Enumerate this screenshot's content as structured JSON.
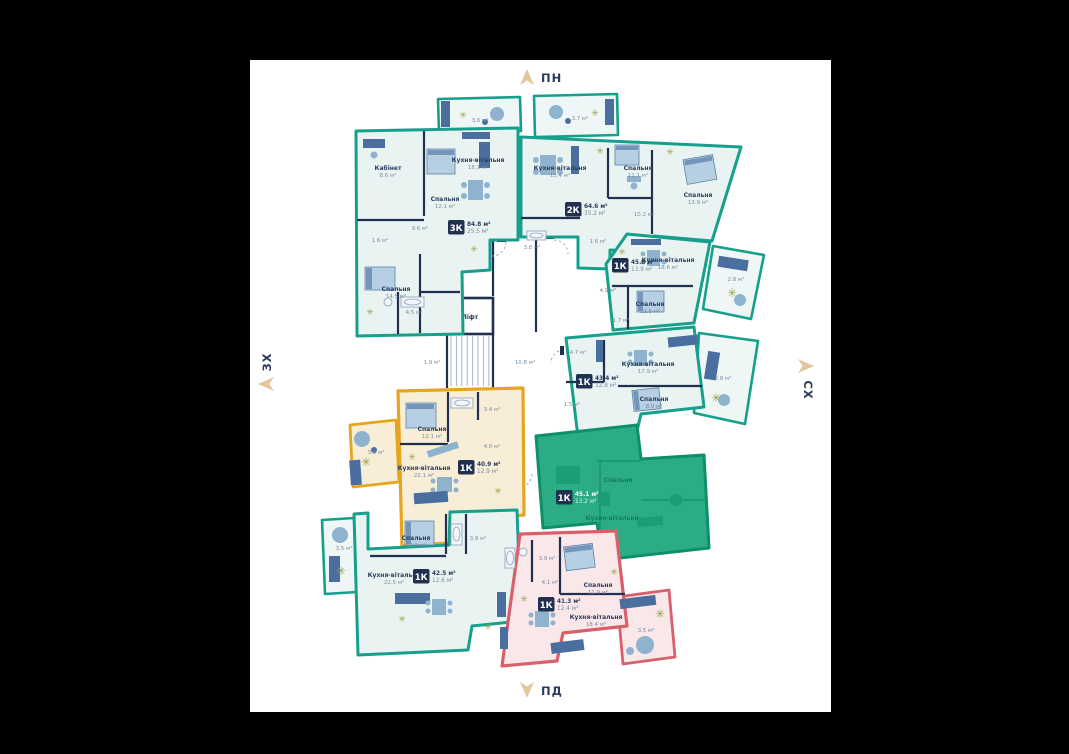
{
  "palette": {
    "available_teal": "#16a08c",
    "reserved_yellow": "#e6a41f",
    "unavailable_pink": "#d9606b",
    "sold_green": "#2bac85",
    "wall_navy": "#22304f",
    "compass_gold": "#e2c79e",
    "paper": "#ffffff",
    "background": "#000000"
  },
  "compass": {
    "north": "ПН",
    "south": "ПД",
    "west": "ЗХ",
    "east": "СХ"
  },
  "core": {
    "lift": "Ліфт",
    "hall_small_area": "1.9 м²",
    "hall_area": "10.8 м²"
  },
  "balconies": {
    "top_left": "3.6 м²",
    "top_right": "3.7 м²",
    "right_upper": "2.8 м²",
    "right_middle": "2.8 м²",
    "yellow": "3.5 м²",
    "bottom_left": "3.5 м²",
    "pink": "3.5 м²"
  },
  "apartments": {
    "a3k": {
      "type": "3К",
      "area_total": "84.8 м²",
      "area_living": "25.5 м²",
      "rooms": {
        "cabinet": {
          "name": "Кабінет",
          "area": "8.6 м²"
        },
        "bedroom1": {
          "name": "Спальня",
          "area": "12.1 м²"
        },
        "kitchen_living": {
          "name": "Кухня-вітальня",
          "area": "18.1 м²"
        },
        "bedroom2": {
          "name": "Спальня",
          "area": "14.5 м²"
        },
        "bath_area": "4.5 м²",
        "hall_area": "9.6 м²",
        "wc_area": "1.6 м²"
      }
    },
    "a2k": {
      "type": "2К",
      "area_total": "64.6 м²",
      "area_living": "35.2 м²",
      "rooms": {
        "kitchen_living": {
          "name": "Кухня-вітальня",
          "area": "15.4 м²"
        },
        "bedroom1": {
          "name": "Спальня",
          "area": "11.1 м²"
        },
        "bedroom2": {
          "name": "Спальня",
          "area": "13.9 м²"
        },
        "hall_area": "10.2 м²",
        "bath_area": "3.8 м²",
        "wc_area": "1.6 м²"
      }
    },
    "a1k_right": {
      "type": "1К",
      "area_total": "45.8 м²",
      "area_living": "13.9 м²",
      "rooms": {
        "kitchen_living": {
          "name": "Кухня-вітальня",
          "area": "18.6 м²"
        },
        "bedroom": {
          "name": "Спальня",
          "area": "12.5 м²"
        },
        "hall_area": "4.9 м²",
        "wc_area": "1.7 м²"
      }
    },
    "a1k_mid": {
      "type": "1К",
      "area_total": "43.4 м²",
      "area_living": "12.8 м²",
      "rooms": {
        "kitchen_living": {
          "name": "Кухня-вітальня",
          "area": "17.9 м²"
        },
        "bedroom": {
          "name": "Спальня",
          "area": "8.9 м²"
        },
        "hall_area": "4.7 м²",
        "wc_area": "1.5 м²"
      }
    },
    "a1k_yellow": {
      "type": "1К",
      "area_total": "40.9 м²",
      "area_living": "12.9 м²",
      "rooms": {
        "bedroom": {
          "name": "Спальня",
          "area": "12.1 м²"
        },
        "kitchen_living": {
          "name": "Кухня-вітальня",
          "area": "22.1 м²"
        },
        "bath_area": "3.4 м²",
        "hall_area": "4.0 м²"
      }
    },
    "a1k_sold": {
      "type": "1К",
      "area_total": "45.1 м²",
      "area_living": "13.2 м²",
      "rooms": {
        "bedroom": {
          "name": "Спальня"
        },
        "kitchen_living": {
          "name": "Кухня-вітальня"
        }
      }
    },
    "a1k_bottom": {
      "type": "1К",
      "area_total": "42.5 м²",
      "area_living": "12.6 м²",
      "rooms": {
        "bedroom": {
          "name": "Спальня",
          "area": "12.1 м²"
        },
        "kitchen_living": {
          "name": "Кухня-вітальня",
          "area": "22.5 м²"
        },
        "bath_area": "3.9 м²"
      }
    },
    "a1k_pink": {
      "type": "1К",
      "area_total": "41.3 м²",
      "area_living": "12.4 м²",
      "rooms": {
        "bedroom": {
          "name": "Спальня",
          "area": "11.9 м²"
        },
        "kitchen_living": {
          "name": "Кухня-вітальня",
          "area": "18.4 м²"
        },
        "bath_area": "3.9 м²",
        "hall_area": "4.1 м²"
      }
    }
  }
}
